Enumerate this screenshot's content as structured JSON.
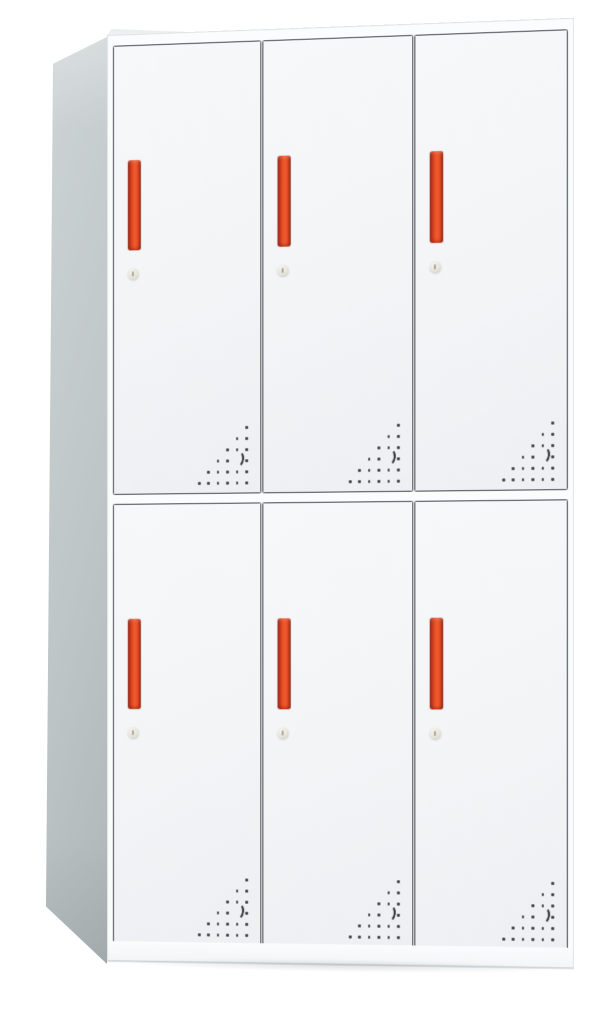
{
  "cabinet": {
    "rows": 2,
    "columns": 3,
    "door_count": 6,
    "handles_per_door": 1,
    "locks_per_door": 1,
    "vent_pattern": {
      "rows": 6,
      "row_counts": [
        1,
        2,
        3,
        4,
        5,
        6
      ],
      "crescent": {
        "skip_row": 3,
        "skip_col": 1
      }
    },
    "colors": {
      "page_bg": "#ffffff",
      "front_frame": "#fbfcfd",
      "front_edge": "#dfe3e5",
      "door_face_light": "#f7f8fa",
      "door_face": "#f2f4f6",
      "door_face_shade": "#edeff2",
      "door_border": "#43484d",
      "side_light": "#ced4d5",
      "side_mid": "#bfc6c8",
      "side_dark": "#aeb6b8",
      "top_face": "#fbfdfd",
      "top_edge": "#dde1e3",
      "handle_core": "#e84f26",
      "handle_bright": "#f05c2e",
      "handle_dark": "#b8311a",
      "handle_deep": "#8c2410",
      "lock_light": "#f6f4ee",
      "lock_mid": "#e6e3d9",
      "lock_dark": "#c8c5b9",
      "keyhole": "#8a8274",
      "dot": "#3f444a",
      "crescent": "#2f343a",
      "bottom_line": "#ced3d6",
      "shadow": "rgba(100,110,115,0.20)"
    }
  }
}
